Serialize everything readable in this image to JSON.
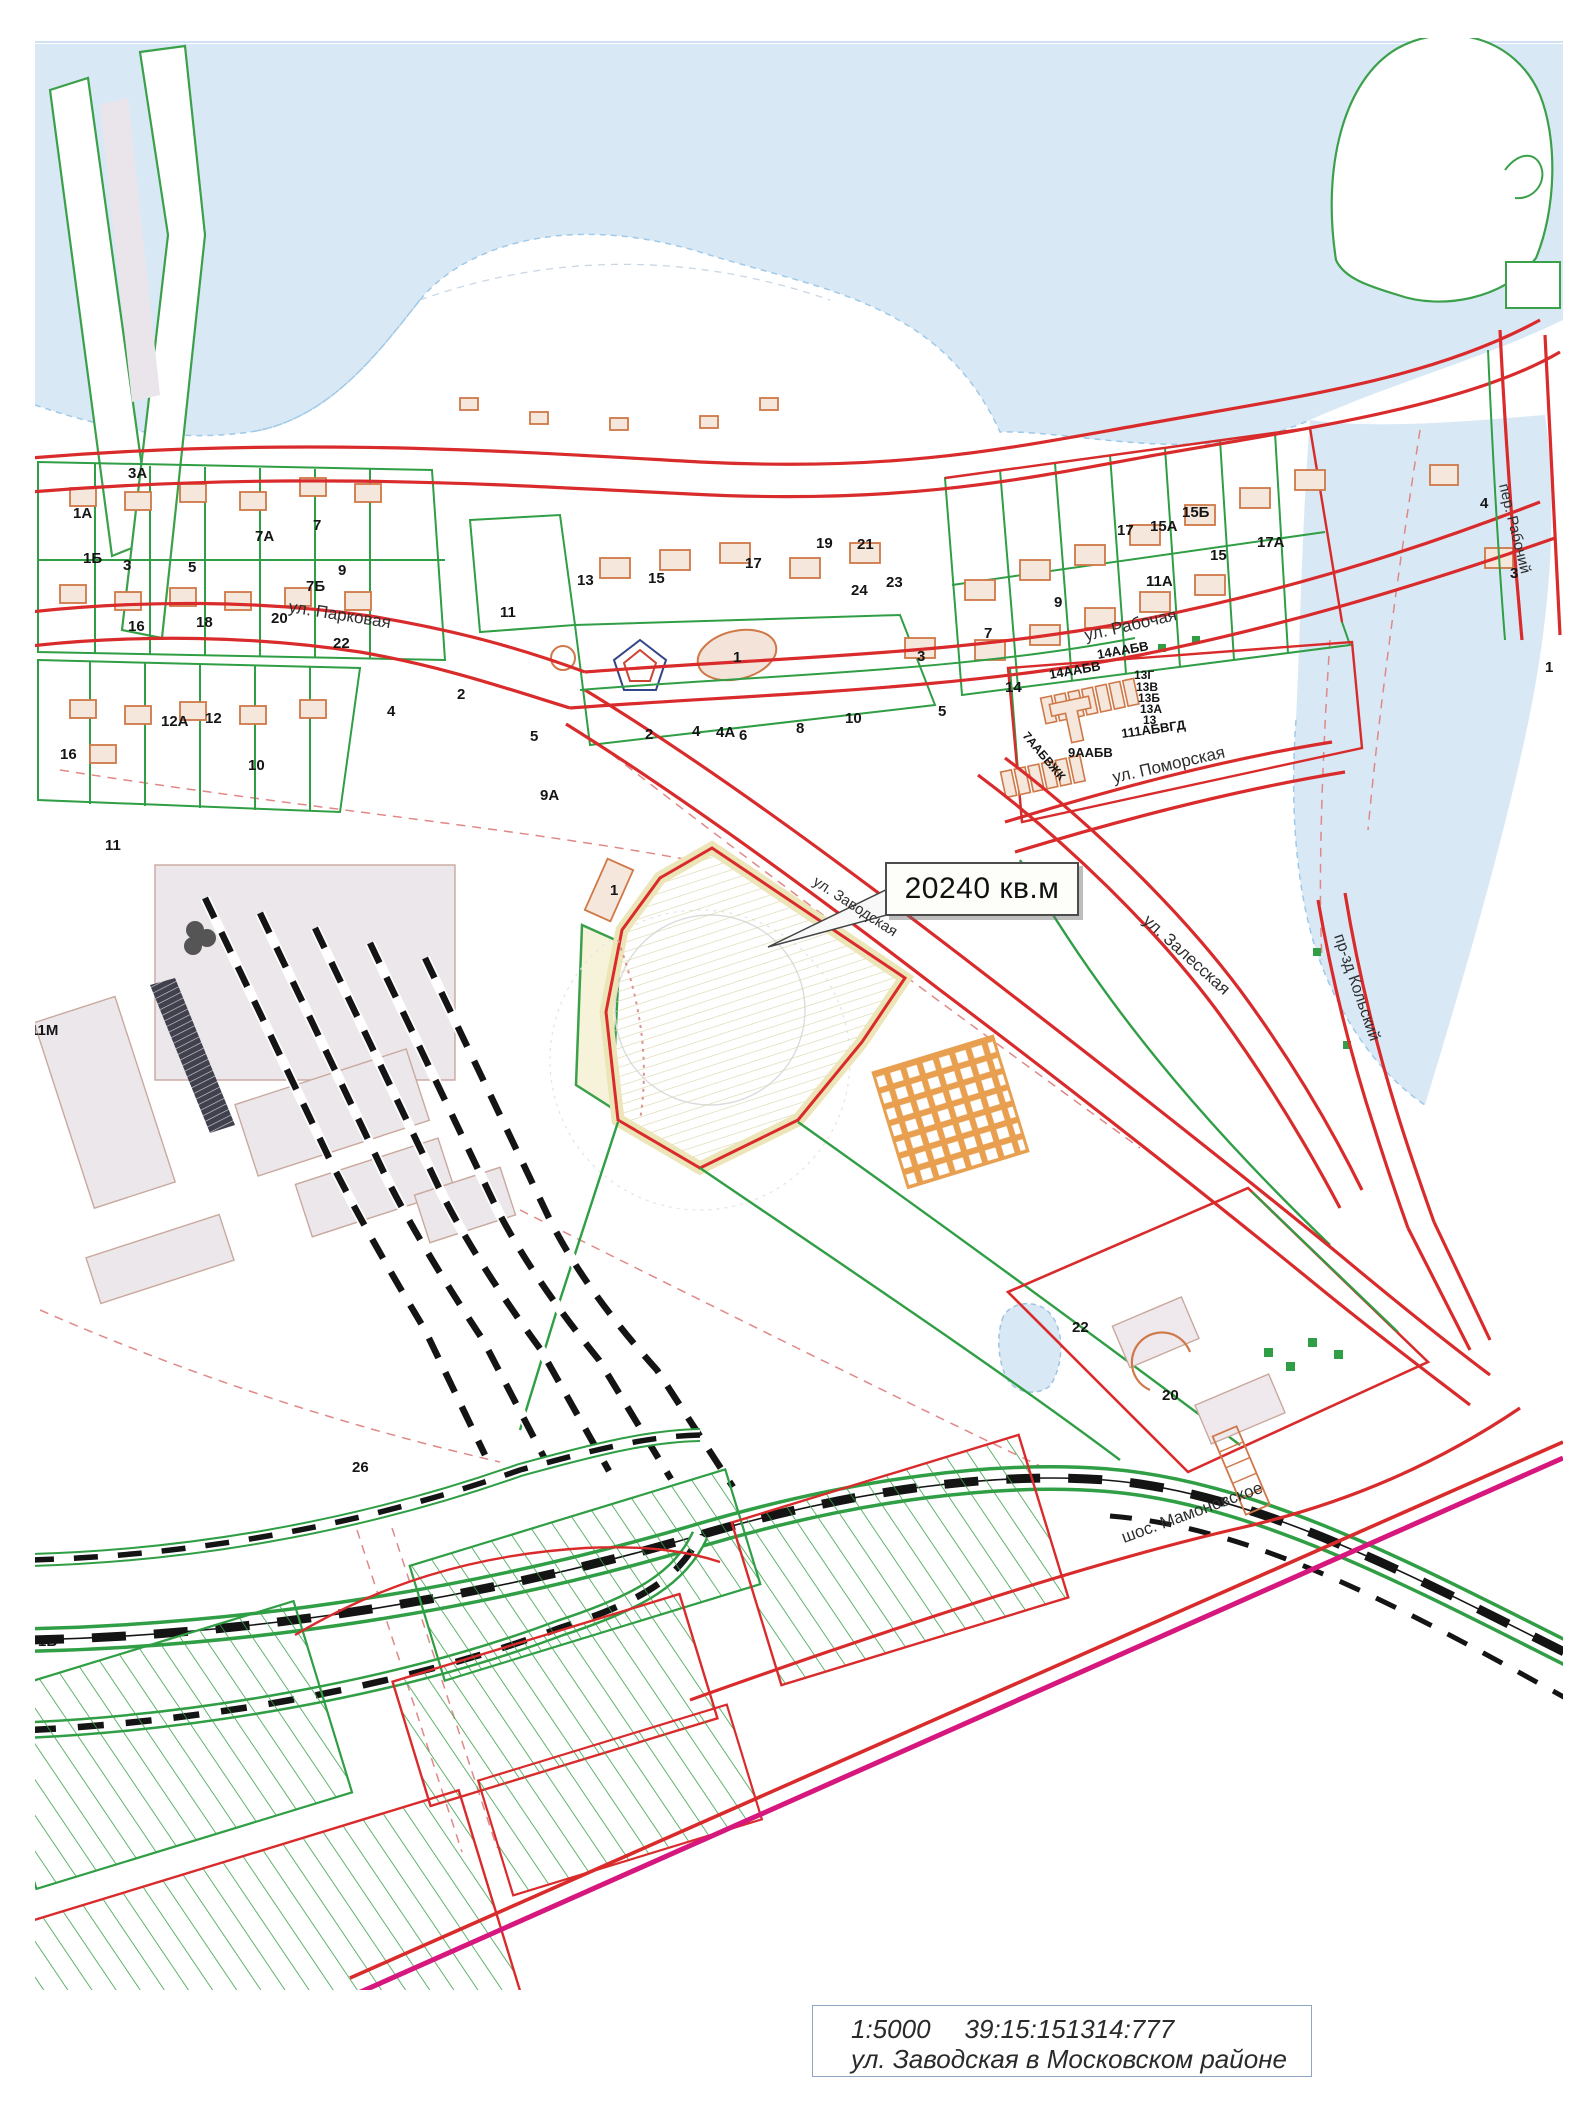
{
  "callout": {
    "area": "20240 кв.м"
  },
  "footer": {
    "scale": "1:5000",
    "cadastral_number": "39:15:151314:777",
    "address": "ул. Заводская в Московском районе"
  },
  "colors": {
    "road_red": "#d92b2b",
    "parcel_green": "#2f9e44",
    "building_orange": "#cf7848",
    "water_blue": "#d9e8f5",
    "highlight_yellow": "#ece5b8",
    "magenta_line": "#d6187e",
    "railway_black": "#1c1c1c"
  },
  "map": {
    "street_labels": [
      {
        "text": "ул. Парковая",
        "x": 288,
        "y": 612,
        "rot": 9,
        "size": 17
      },
      {
        "text": "ул. Рабочая",
        "x": 1086,
        "y": 641,
        "rot": -13,
        "size": 17
      },
      {
        "text": "ул. Поморская",
        "x": 1114,
        "y": 783,
        "rot": -13,
        "size": 17
      },
      {
        "text": "ул. Залесская",
        "x": 1142,
        "y": 922,
        "rot": 42,
        "size": 17
      },
      {
        "text": "пр-зд Кольский",
        "x": 1334,
        "y": 936,
        "rot": 71,
        "size": 16
      },
      {
        "text": "ул. Заводская",
        "x": 812,
        "y": 884,
        "rot": 33,
        "size": 15
      },
      {
        "text": "шос. Мамоновское",
        "x": 1124,
        "y": 1543,
        "rot": -20,
        "size": 17
      },
      {
        "text": "пер. Рабочий",
        "x": 1499,
        "y": 485,
        "rot": 76,
        "size": 15
      }
    ],
    "parcel_labels": [
      {
        "text": "3А",
        "x": 128,
        "y": 478
      },
      {
        "text": "1А",
        "x": 73,
        "y": 518
      },
      {
        "text": "1Б",
        "x": 83,
        "y": 563
      },
      {
        "text": "3",
        "x": 123,
        "y": 570
      },
      {
        "text": "5",
        "x": 188,
        "y": 572
      },
      {
        "text": "7А",
        "x": 255,
        "y": 541
      },
      {
        "text": "7",
        "x": 313,
        "y": 530
      },
      {
        "text": "9",
        "x": 338,
        "y": 575
      },
      {
        "text": "7Б",
        "x": 306,
        "y": 591
      },
      {
        "text": "20",
        "x": 271,
        "y": 623
      },
      {
        "text": "16",
        "x": 128,
        "y": 631
      },
      {
        "text": "18",
        "x": 196,
        "y": 627
      },
      {
        "text": "22",
        "x": 333,
        "y": 648
      },
      {
        "text": "12А",
        "x": 161,
        "y": 726
      },
      {
        "text": "12",
        "x": 205,
        "y": 723
      },
      {
        "text": "16",
        "x": 60,
        "y": 759
      },
      {
        "text": "10",
        "x": 248,
        "y": 770
      },
      {
        "text": "4",
        "x": 387,
        "y": 716
      },
      {
        "text": "2",
        "x": 457,
        "y": 699
      },
      {
        "text": "5",
        "x": 530,
        "y": 741
      },
      {
        "text": "9А",
        "x": 540,
        "y": 800
      },
      {
        "text": "11",
        "x": 500,
        "y": 617
      },
      {
        "text": "13",
        "x": 577,
        "y": 585
      },
      {
        "text": "15",
        "x": 648,
        "y": 583
      },
      {
        "text": "17",
        "x": 745,
        "y": 568
      },
      {
        "text": "19",
        "x": 816,
        "y": 548
      },
      {
        "text": "21",
        "x": 857,
        "y": 549
      },
      {
        "text": "23",
        "x": 886,
        "y": 587
      },
      {
        "text": "24",
        "x": 851,
        "y": 595
      },
      {
        "text": "2",
        "x": 645,
        "y": 739
      },
      {
        "text": "4",
        "x": 692,
        "y": 736
      },
      {
        "text": "4А",
        "x": 716,
        "y": 737
      },
      {
        "text": "6",
        "x": 739,
        "y": 740
      },
      {
        "text": "8",
        "x": 796,
        "y": 733
      },
      {
        "text": "10",
        "x": 845,
        "y": 723
      },
      {
        "text": "5",
        "x": 938,
        "y": 716
      },
      {
        "text": "3",
        "x": 917,
        "y": 661
      },
      {
        "text": "7",
        "x": 984,
        "y": 638
      },
      {
        "text": "9",
        "x": 1054,
        "y": 607
      },
      {
        "text": "14",
        "x": 1005,
        "y": 692
      },
      {
        "text": "15Б",
        "x": 1182,
        "y": 517
      },
      {
        "text": "15А",
        "x": 1150,
        "y": 531
      },
      {
        "text": "17",
        "x": 1117,
        "y": 535
      },
      {
        "text": "17А",
        "x": 1257,
        "y": 547
      },
      {
        "text": "15",
        "x": 1210,
        "y": 560
      },
      {
        "text": "11А",
        "x": 1146,
        "y": 586
      },
      {
        "text": "14ААБВ",
        "x": 1050,
        "y": 679,
        "rot": -10,
        "size": 13
      },
      {
        "text": "14ААБВ",
        "x": 1098,
        "y": 659,
        "rot": -10,
        "size": 13
      },
      {
        "text": "13Г",
        "x": 1134,
        "y": 679,
        "size": 12
      },
      {
        "text": "13В",
        "x": 1136,
        "y": 691,
        "size": 12
      },
      {
        "text": "13Б",
        "x": 1138,
        "y": 702,
        "size": 12
      },
      {
        "text": "13А",
        "x": 1140,
        "y": 713,
        "size": 12
      },
      {
        "text": "13",
        "x": 1143,
        "y": 724,
        "size": 12
      },
      {
        "text": "111АБВГД",
        "x": 1122,
        "y": 738,
        "rot": -8,
        "size": 13
      },
      {
        "text": "9ААБВ",
        "x": 1068,
        "y": 757,
        "size": 13
      },
      {
        "text": "7ААБВЖК",
        "x": 1022,
        "y": 736,
        "rot": 50,
        "size": 12
      },
      {
        "text": "4",
        "x": 1480,
        "y": 508
      },
      {
        "text": "3",
        "x": 1510,
        "y": 578
      },
      {
        "text": "1",
        "x": 1545,
        "y": 672
      },
      {
        "text": "1",
        "x": 733,
        "y": 662
      },
      {
        "text": "1",
        "x": 610,
        "y": 895
      },
      {
        "text": "11",
        "x": 105,
        "y": 850
      },
      {
        "text": "11М",
        "x": 30,
        "y": 1035
      },
      {
        "text": "26",
        "x": 352,
        "y": 1472
      },
      {
        "text": "22",
        "x": 1072,
        "y": 1332
      },
      {
        "text": "20",
        "x": 1162,
        "y": 1400
      },
      {
        "text": "1Б",
        "x": 38,
        "y": 1646
      }
    ]
  }
}
